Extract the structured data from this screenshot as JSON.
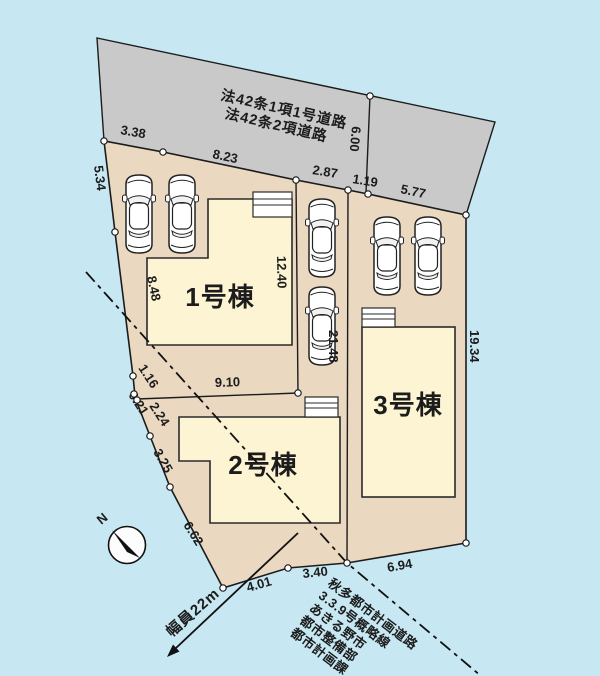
{
  "colors": {
    "background": "#c7e8f2",
    "road": "#c9c9c9",
    "lot": "#ead8c0",
    "building": "#fcf4d3",
    "porch": "#ffffff",
    "outline": "#1c1c1c"
  },
  "road": {
    "label_line1": "法42条1項1号道路",
    "label_line2": "法42条2項道路"
  },
  "buildings": [
    {
      "label": "1号棟"
    },
    {
      "label": "2号棟"
    },
    {
      "label": "3号棟"
    }
  ],
  "dimensions": {
    "top_1": "3.38",
    "top_2": "8.23",
    "top_3": "2.87",
    "top_4": "1.19",
    "top_5": "5.77",
    "road_depth": "6.00",
    "left_1": "5.34",
    "left_2": "8.48",
    "left_3": "1.16",
    "left_4": "0.21",
    "left_5": "2.24",
    "left_6": "3.25",
    "left_7": "6.62",
    "bottom_1": "4.01",
    "bottom_2": "3.40",
    "bottom_3": "6.94",
    "inner_h": "9.10",
    "inner_v1": "12.40",
    "inner_v2": "21.48",
    "right_1": "19.34"
  },
  "annotations": {
    "road_width": "幅員22m",
    "compass": "N",
    "note_lines": [
      "秋多都市計画道路",
      "3.3.9号概略線",
      "あきる野市",
      "都市整備部",
      "都市計画課"
    ]
  }
}
